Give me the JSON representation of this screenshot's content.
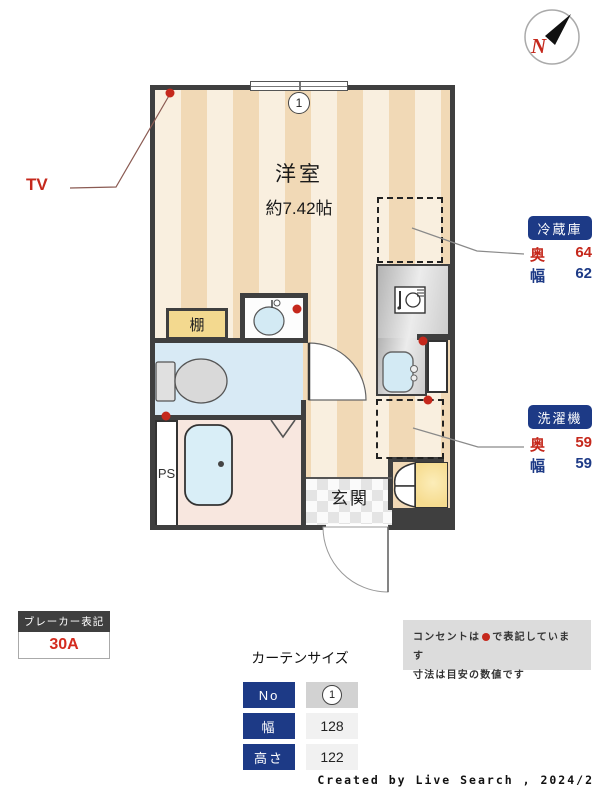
{
  "plan": {
    "room_label": "洋室",
    "room_size": "約7.42帖",
    "window_no": "1",
    "shelf_label": "棚",
    "ps_label": "PS",
    "entrance_label": "玄関"
  },
  "compass": {
    "north_label": "N"
  },
  "callouts": {
    "tv_label": "TV",
    "fridge": {
      "title": "冷蔵庫",
      "rows": [
        {
          "label": "奥",
          "value": "64"
        },
        {
          "label": "幅",
          "value": "62"
        }
      ]
    },
    "washer": {
      "title": "洗濯機",
      "rows": [
        {
          "label": "奥",
          "value": "59"
        },
        {
          "label": "幅",
          "value": "59"
        }
      ]
    }
  },
  "breaker": {
    "title": "ブレーカー表記",
    "value": "30A"
  },
  "curtain": {
    "title": "カーテンサイズ",
    "rows": [
      {
        "label": "No",
        "value": "1"
      },
      {
        "label": "幅",
        "value": "128"
      },
      {
        "label": "高さ",
        "value": "122"
      }
    ]
  },
  "note": {
    "line1_pre": "コンセントは",
    "line1_post": "で表記しています",
    "line2": "寸法は目安の数値です"
  },
  "credit": "Created by Live Search , 2024/2",
  "colors": {
    "wall": "#3f3f3f",
    "stripeLight": "#f9efdf",
    "stripeDark": "#f1d9b6",
    "navy": "#1d3a86",
    "red": "#c5281c",
    "toiletBlue": "#d8eaf5",
    "bathPink": "#f8e7df",
    "tubBlue": "#cde7f2",
    "shelfTan": "#f3d98f",
    "closetYellow": "#f6dc90",
    "noteGray": "#dcdcdc"
  }
}
